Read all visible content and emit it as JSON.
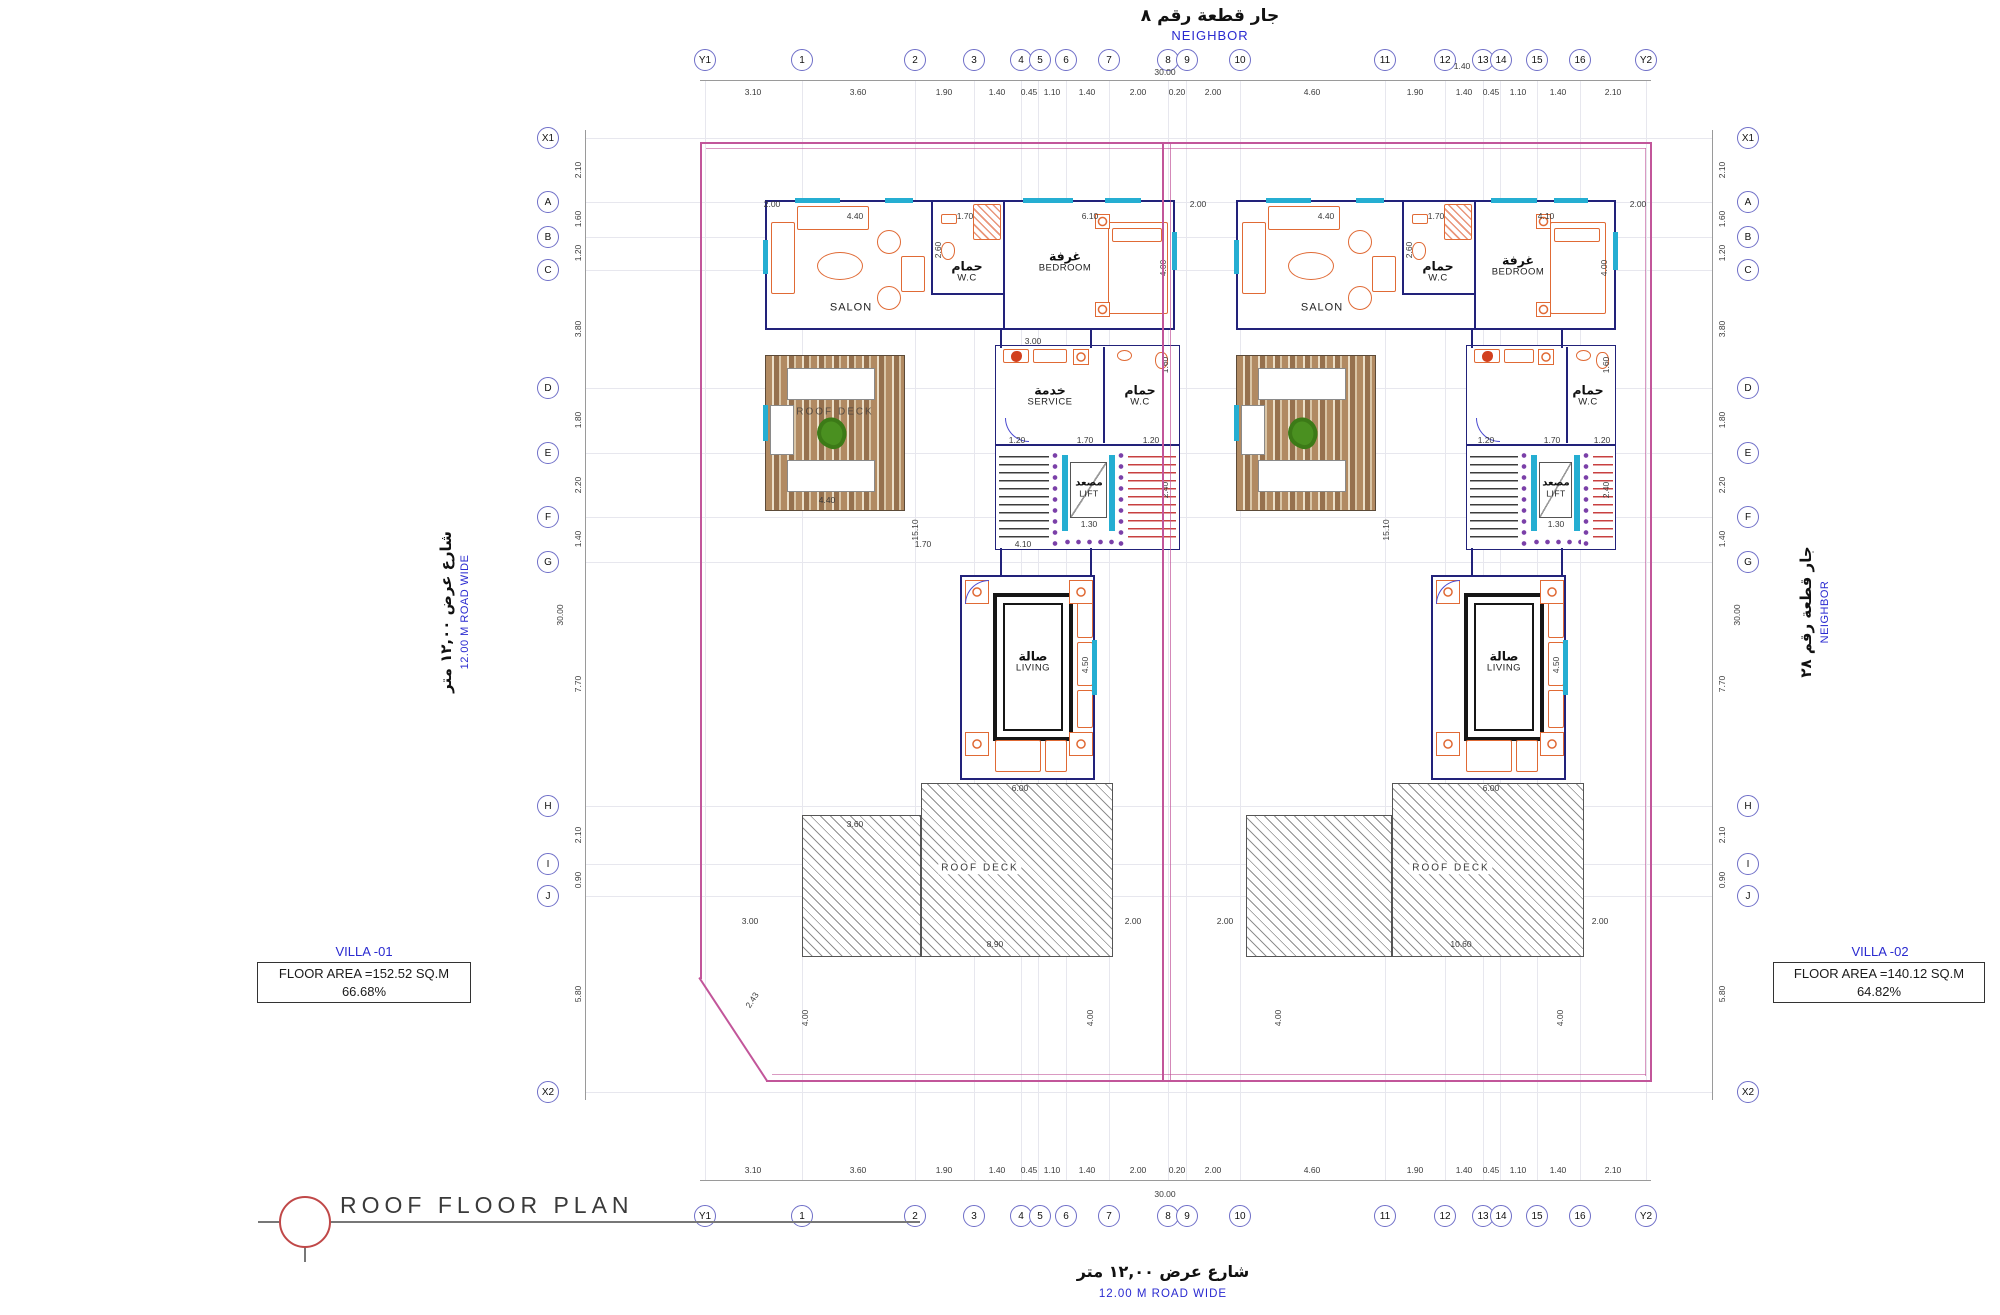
{
  "meta": {
    "drawing_title": "ROOF FLOOR PLAN"
  },
  "boundary_labels": {
    "top_ar": "جار قطعة رقم ٨",
    "top_en": "NEIGHBOR",
    "right_ar": "جار قطعة رقم ٢٨",
    "right_en": "NEIGHBOR",
    "left_ar": "شارع عرض ١٢,٠٠ متر",
    "left_en": "12.00 M ROAD WIDE",
    "bottom_ar": "شارع عرض ١٢,٠٠ متر",
    "bottom_en": "12.00 M ROAD WIDE"
  },
  "grid": {
    "h_bubbles": [
      "Y1",
      "1",
      "2",
      "3",
      "4",
      "5",
      "6",
      "7",
      "8",
      "9",
      "10",
      "11",
      "12",
      "13",
      "14",
      "15",
      "16",
      "Y2"
    ],
    "v_bubbles": [
      "X1",
      "A",
      "B",
      "C",
      "D",
      "E",
      "F",
      "G",
      "H",
      "I",
      "J",
      "X2"
    ],
    "h_dims": [
      "3.10",
      "3.60",
      "1.90",
      "1.40",
      "0.45",
      "1.10",
      "1.40",
      "2.00",
      "0.20",
      "2.00",
      "4.60",
      "1.90",
      "1.40",
      "0.45",
      "1.10",
      "1.40",
      "2.10"
    ],
    "v_dims": [
      "2.10",
      "1.60",
      "1.20",
      "3.80",
      "1.80",
      "2.20",
      "1.40",
      "7.70",
      "2.10",
      "0.90",
      "5.80"
    ],
    "overall": "30.00",
    "extra_top": "1.40"
  },
  "villa1": {
    "name": "VILLA  -01",
    "floor_area": "FLOOR  AREA  =152.52  SQ.M",
    "percent": "66.68%"
  },
  "villa2": {
    "name": "VILLA  -02",
    "floor_area": "FLOOR  AREA  =140.12  SQ.M",
    "percent": "64.82%"
  },
  "rooms": {
    "salon": "SALON",
    "wc_ar": "حمام",
    "wc_en": "W.C",
    "bedroom_ar": "غرفة",
    "bedroom_en": "BEDROOM",
    "service_ar": "خدمة",
    "service_en": "SERVICE",
    "lift_ar": "مصعد",
    "lift_en": "LIFT",
    "living_ar": "صالة",
    "living_en": "LIVING",
    "roof_deck": "ROOF DECK"
  },
  "inner_dims": {
    "d200": "2.00",
    "d440": "4.40",
    "d170": "1.70",
    "d610": "6.10",
    "d410": "4.10",
    "d400": "4.00",
    "d260": "2.60",
    "d300": "3.00",
    "d1510": "15.10",
    "d120": "1.20",
    "d130": "1.30",
    "d160": "1.60",
    "d240": "2.40",
    "d600": "6.00",
    "d450": "4.50",
    "d360": "3.60",
    "d890": "8.90",
    "d1060": "10.60",
    "d243": "2.43"
  }
}
